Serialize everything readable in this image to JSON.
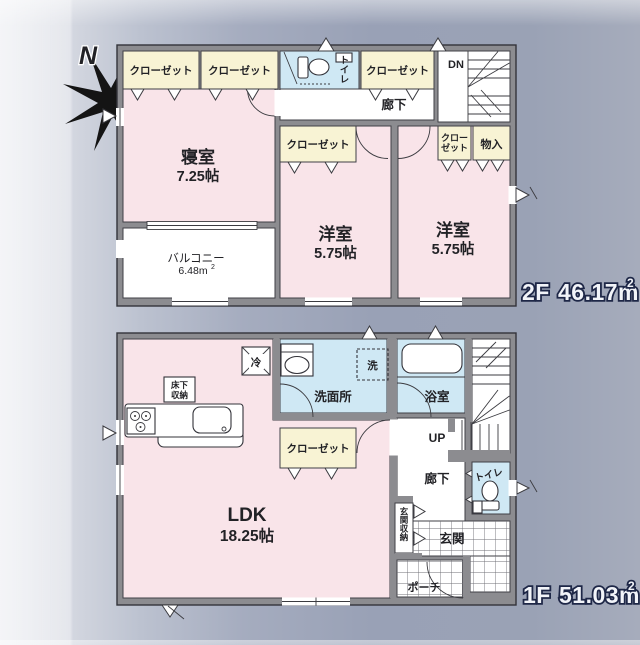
{
  "compass": {
    "north_label": "N"
  },
  "floor2": {
    "floor_name": "2F",
    "area_value": "46.17m",
    "area_sup": "2",
    "bedroom": {
      "name": "寝室",
      "size": "7.25帖"
    },
    "western_left": {
      "name": "洋室",
      "size": "5.75帖"
    },
    "western_right": {
      "name": "洋室",
      "size": "5.75帖"
    },
    "balcony": {
      "name": "バルコニー",
      "size_value": "6.48m",
      "size_sup": "2"
    },
    "closet_top1": "クローゼット",
    "closet_top2": "クローゼット",
    "closet_top3": "クローゼット",
    "closet_mid": "クローゼット",
    "closet_small_line1": "クロー",
    "closet_small_line2": "ゼット",
    "storage": "物入",
    "toilet": "トイレ",
    "hallway": "廊下",
    "stairs": "DN"
  },
  "floor1": {
    "floor_name": "1F",
    "area_value": "51.03m",
    "area_sup": "2",
    "ldk": {
      "name": "LDK",
      "size": "18.25帖"
    },
    "washroom": "洗面所",
    "bathroom": "浴室",
    "washer": "洗",
    "fridge": "冷",
    "floor_storage_line1": "床下",
    "floor_storage_line2": "収納",
    "closet": "クローゼット",
    "hallway": "廊下",
    "toilet": "トイレ",
    "stairs": "UP",
    "entrance": "玄関",
    "entrance_storage": "玄関収納",
    "porch": "ポーチ"
  }
}
